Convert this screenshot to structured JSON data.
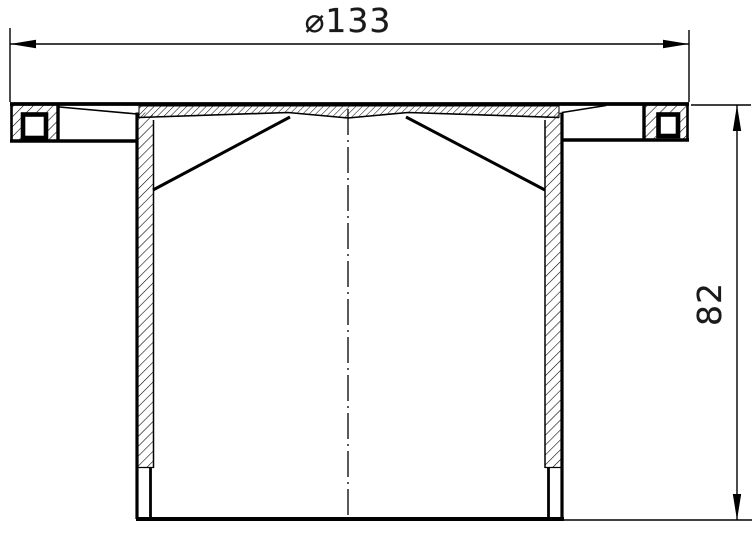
{
  "drawing": {
    "dimensions": {
      "diameter": {
        "label": "⌀133",
        "value": 133
      },
      "height": {
        "label": "82",
        "value": 82
      }
    },
    "style": {
      "line_color": "#000000",
      "background": "#ffffff"
    }
  }
}
